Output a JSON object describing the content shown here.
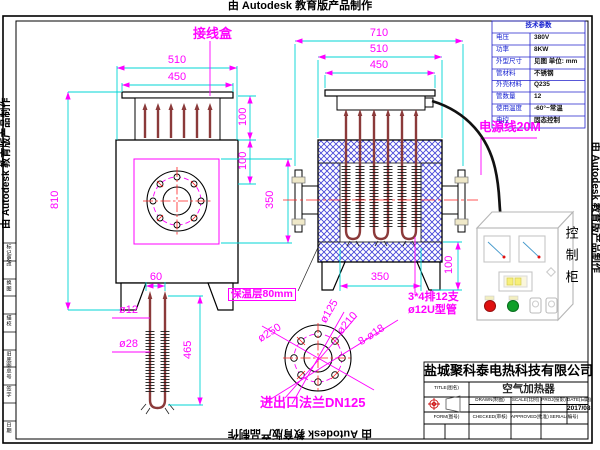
{
  "watermark": {
    "text": "由 Autodesk 教育版产品制作"
  },
  "params_table": {
    "title": "技术参数",
    "rows": [
      {
        "label": "电压",
        "value": "380V"
      },
      {
        "label": "功率",
        "value": "8KW"
      },
      {
        "label": "外型尺寸",
        "value": "见图 单位: mm"
      },
      {
        "label": "管材料",
        "value": "不锈钢"
      },
      {
        "label": "外壳材料",
        "value": "Q235"
      },
      {
        "label": "管数量",
        "value": "12"
      },
      {
        "label": "使用温度",
        "value": "-60°~常温"
      },
      {
        "label": "电控",
        "value": "固态控制"
      }
    ]
  },
  "labels": {
    "junction_box": "接线盒",
    "power_cable": "电源线20M",
    "insulation": "保温层80mm",
    "tube_count_line1": "3*4排12支",
    "tube_count_line2": "ø12U型管",
    "flange_note": "进出口法兰DN125",
    "control_cabinet": "控制柜"
  },
  "dims": {
    "left_view": {
      "w1": "510",
      "w2": "450",
      "h": "810",
      "t1": "100",
      "t2": "100",
      "mid": "350"
    },
    "front_view": {
      "w1": "710",
      "w2": "510",
      "w3": "450",
      "bottom": "350",
      "leg": "100"
    },
    "element": {
      "pitch": "60",
      "d1": "ø12",
      "d2": "ø28",
      "len": "465"
    },
    "flange": {
      "outer": "ø250",
      "inner": "ø125",
      "bolt": "ø210",
      "holes": "8-ø18"
    }
  },
  "title_block": {
    "company": "盐城聚科泰电热科技有限公司",
    "title_label": "TITLE(图名)",
    "title": "空气加热器",
    "drawn_label": "DRAWN(制图)",
    "scale_label": "SCALE(比例)",
    "proj_label": "PROJ(投影)",
    "date_label": "DATE(日期)",
    "date": "2017/08",
    "form_label": "FORM(图号)",
    "checked_label": "CHECKED(审核)",
    "approved_label": "APPROVED(批准)",
    "serial_label": "SERIAL(编号)"
  },
  "revision_strip": {
    "rows": [
      "标记更改",
      "换图",
      "描校",
      "旧底图总号",
      "签字",
      "日期"
    ]
  },
  "colors": {
    "dimension": "#FF00FF",
    "extension": "#00D4D4",
    "hatch": "#4747D8",
    "centerline": "#FF2020",
    "tube": "#8B3A3A",
    "table_label": "#1520D0"
  }
}
